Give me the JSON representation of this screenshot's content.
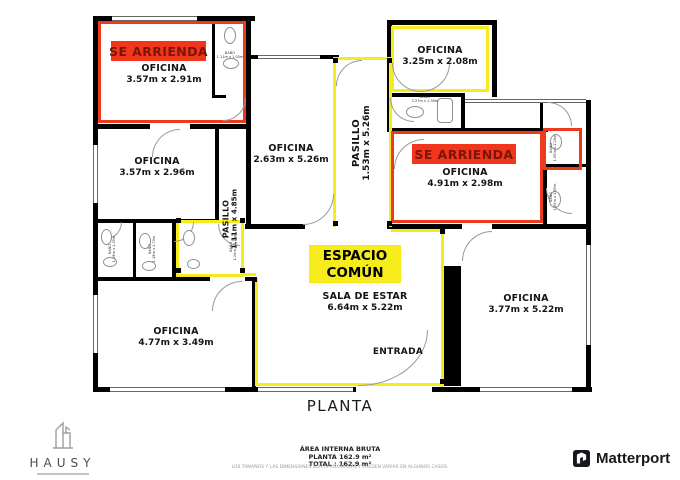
{
  "colors": {
    "highlight_red": "#ee3a1c",
    "banner_red_bg": "#f2361c",
    "banner_red_text": "#7a1508",
    "highlight_yellow": "#f6ec1c",
    "wall": "#000000"
  },
  "plan": {
    "rooms": [
      {
        "key": "office-top-left",
        "name": "OFICINA",
        "dims": "3.57m x 2.91m"
      },
      {
        "key": "office-left",
        "name": "OFICINA",
        "dims": "3.57m x 2.96m"
      },
      {
        "key": "office-center",
        "name": "OFICINA",
        "dims": "2.63m x 5.26m"
      },
      {
        "key": "office-top-right",
        "name": "OFICINA",
        "dims": "3.25m x 2.08m"
      },
      {
        "key": "office-right",
        "name": "OFICINA",
        "dims": "4.91m x 2.98m"
      },
      {
        "key": "office-bottom-left",
        "name": "OFICINA",
        "dims": "4.77m x 3.49m"
      },
      {
        "key": "office-bottom-right",
        "name": "OFICINA",
        "dims": "3.77m x 5.22m"
      },
      {
        "key": "living-room",
        "name": "SALA DE ESTAR",
        "dims": "6.64m x 5.22m"
      }
    ],
    "halls": [
      {
        "key": "hall-main",
        "name": "PASILLO",
        "dims": "1.53m x 5.26m"
      },
      {
        "key": "hall-left",
        "name": "PASILLO",
        "dims": "1.11m x 4.85m"
      }
    ],
    "baths": [
      {
        "name": "BAÑO",
        "dims": "1.11m x 1.05m"
      },
      {
        "name": "BAÑO",
        "dims": "2.27m x 1.30m"
      },
      {
        "name": "BAÑO",
        "dims": "1.05m x 1.26m"
      },
      {
        "name": "BAÑO",
        "dims": "1.05m x 1.85m"
      },
      {
        "name": "BAÑO",
        "dims": "1.19m x 1.05m"
      },
      {
        "name": "BAÑO",
        "dims": "1.19m x 1.70m"
      },
      {
        "name": "BAÑO",
        "dims": "1.24m x 1.70m"
      }
    ],
    "banners": {
      "rent1": "SE ARRIENDA",
      "rent2": "SE ARRIENDA",
      "common_line1": "ESPACIO",
      "common_line2": "COMÚN"
    },
    "entrance_label": "ENTRADA"
  },
  "footer": {
    "plan_title": "PLANTA",
    "area_heading": "ÁREA INTERNA BRUTA",
    "area_plan": "PLANTA 162.9 m²",
    "area_total": "TOTAL : 162.9 m²",
    "disclaimer": "LOS TAMAÑOS Y LAS DIMENSIONES SON APROXIMADAS Y PUEDEN VARIAR EN ALGUNOS CASOS."
  },
  "branding": {
    "agency": "HAUSY",
    "provider": "Matterport"
  }
}
